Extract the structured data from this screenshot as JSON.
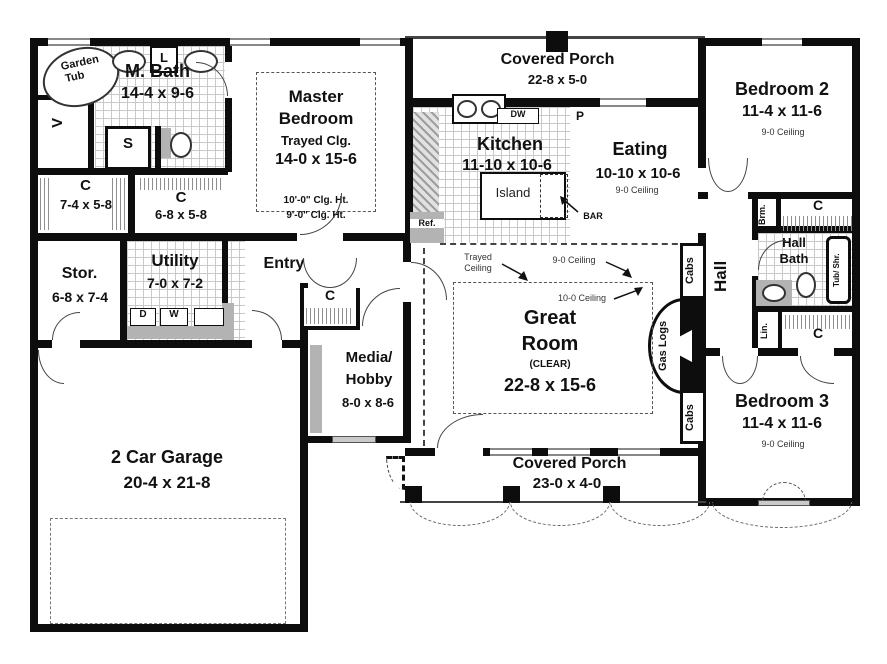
{
  "rooms": {
    "m_bath": {
      "name": "M. Bath",
      "dims": "14-4 x 9-6"
    },
    "master_bedroom": {
      "line1": "Master",
      "line2": "Bedroom",
      "note": "Trayed Clg.",
      "dims": "14-0 x 15-6",
      "clg_hi": "10'-0\" Clg. Ht.",
      "clg_lo": "9'-0\" Clg. Ht."
    },
    "porch_top": {
      "name": "Covered Porch",
      "dims": "22-8 x 5-0"
    },
    "kitchen": {
      "name": "Kitchen",
      "dims": "11-10 x 10-6"
    },
    "eating": {
      "name": "Eating",
      "dims": "10-10 x 10-6",
      "ceiling": "9-0 Ceiling"
    },
    "bedroom2": {
      "name": "Bedroom 2",
      "dims": "11-4 x 11-6",
      "ceiling": "9-0 Ceiling"
    },
    "closet_master1": {
      "name": "C",
      "dims": "7-4 x 5-8"
    },
    "closet_master2": {
      "name": "C",
      "dims": "6-8 x 5-8"
    },
    "storage": {
      "name": "Stor.",
      "dims": "6-8 x 7-4"
    },
    "utility": {
      "name": "Utility",
      "dims": "7-0 x 7-2"
    },
    "entry": {
      "name": "Entry"
    },
    "closet_entry": {
      "name": "C"
    },
    "media": {
      "line1": "Media/",
      "line2": "Hobby",
      "dims": "8-0 x 8-6"
    },
    "great_room": {
      "line1": "Great",
      "line2": "Room",
      "note": "(CLEAR)",
      "dims": "22-8 x 15-6"
    },
    "hall": {
      "name": "Hall"
    },
    "hall_bath": {
      "line1": "Hall",
      "line2": "Bath"
    },
    "closet_hall_upper": {
      "name": "C"
    },
    "closet_hall_lower": {
      "name": "C"
    },
    "bedroom3": {
      "name": "Bedroom 3",
      "dims": "11-4 x 11-6",
      "ceiling": "9-0 Ceiling"
    },
    "garage": {
      "name": "2 Car Garage",
      "dims": "20-4 x 21-8"
    },
    "porch_bottom": {
      "name": "Covered Porch",
      "dims": "23-0 x 4-0"
    }
  },
  "annotations": {
    "trayed_line1": "Trayed",
    "trayed_line2": "Ceiling",
    "ceiling_9": "9-0 Ceiling",
    "ceiling_10": "10-0 Ceiling"
  },
  "fixtures": {
    "garden_line1": "Garden",
    "garden_line2": "Tub",
    "linen_cab": "L",
    "shower": "S",
    "vanity_v": "V",
    "dishwasher": "DW",
    "pantry": "P",
    "fridge": "Ref.",
    "island": "Island",
    "bar": "BAR",
    "dryer": "D",
    "washer": "W",
    "cabs_top": "Cabs",
    "cabs_bottom": "Cabs",
    "gas_logs": "Gas Logs",
    "broom": "Brm.",
    "tub_shower": "Tub/ Shr.",
    "linen_hall": "Lin."
  },
  "colors": {
    "wall": "#0d0d0d",
    "counter": "#b3b3b3"
  }
}
